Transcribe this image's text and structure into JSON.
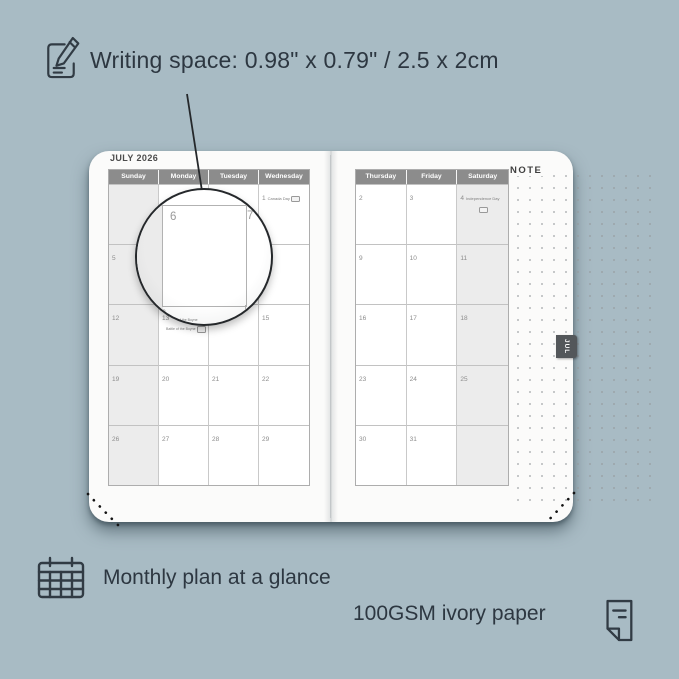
{
  "top_note": {
    "text": "Writing space: 0.98\" x 0.79\" / 2.5 x 2cm"
  },
  "bottom_notes": {
    "monthly": "Monthly plan at a glance",
    "paper": "100GSM ivory paper"
  },
  "planner": {
    "month_title": "JULY 2026",
    "note_label": "NOTE",
    "tab_label": "JUL",
    "magnifier": {
      "day": "6",
      "adjacent_day": "7",
      "below_day": "13",
      "below_holiday": "Battle of the Boyne"
    },
    "left_page": {
      "day_headers": [
        "Sunday",
        "Monday",
        "Tuesday",
        "Wednesday"
      ],
      "shaded_column": 0,
      "weeks": [
        [
          {
            "day": ""
          },
          {
            "day": ""
          },
          {
            "day": ""
          },
          {
            "day": "1",
            "holiday": "Canada Day",
            "badge": "inline"
          }
        ],
        [
          {
            "day": "5"
          },
          {
            "day": "6"
          },
          {
            "day": "7"
          },
          {
            "day": "8"
          }
        ],
        [
          {
            "day": "12"
          },
          {
            "day": "13",
            "holiday": "Battle of the Boyne",
            "badge": "inline",
            "below": true
          },
          {
            "day": "14"
          },
          {
            "day": "15"
          }
        ],
        [
          {
            "day": "19"
          },
          {
            "day": "20"
          },
          {
            "day": "21"
          },
          {
            "day": "22"
          }
        ],
        [
          {
            "day": "26"
          },
          {
            "day": "27"
          },
          {
            "day": "28"
          },
          {
            "day": "29"
          }
        ]
      ]
    },
    "right_page": {
      "day_headers": [
        "Thursday",
        "Friday",
        "Saturday"
      ],
      "shaded_column": 2,
      "weeks": [
        [
          {
            "day": "2"
          },
          {
            "day": "3"
          },
          {
            "day": "4",
            "holiday": "Independence Day",
            "badge": "below"
          }
        ],
        [
          {
            "day": "9"
          },
          {
            "day": "10"
          },
          {
            "day": "11"
          }
        ],
        [
          {
            "day": "16"
          },
          {
            "day": "17"
          },
          {
            "day": "18"
          }
        ],
        [
          {
            "day": "23"
          },
          {
            "day": "24"
          },
          {
            "day": "25"
          }
        ],
        [
          {
            "day": "30"
          },
          {
            "day": "31"
          },
          {
            "day": ""
          }
        ]
      ]
    }
  },
  "colors": {
    "background": "#a8bbc4",
    "page": "#fbfbfa",
    "calendar_header": "#8c8c8c",
    "shaded_cell": "#ececec",
    "tab": "#53575a",
    "annotation_text": "#2d3741"
  }
}
